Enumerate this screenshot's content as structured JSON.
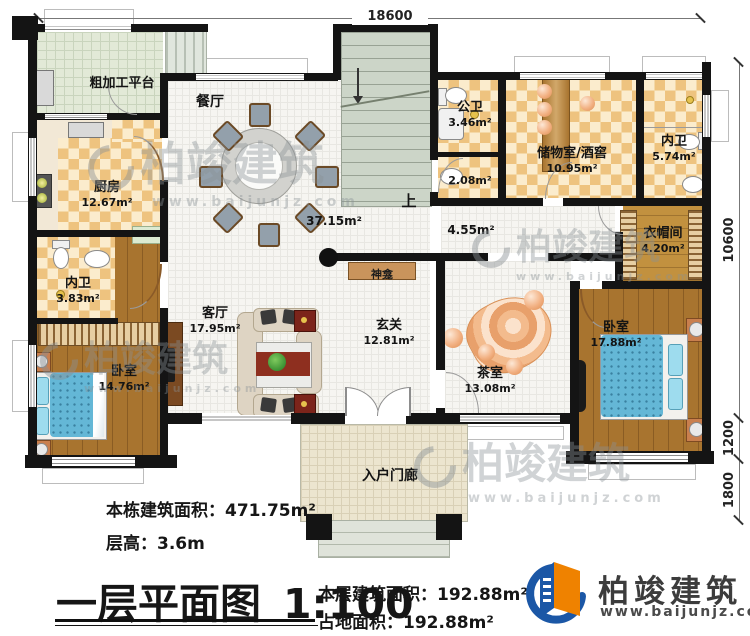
{
  "plan": {
    "title": "一层平面图",
    "scale": "1:100",
    "dimensions": {
      "top": "18600",
      "right_main": "10600",
      "right_mid": "1200",
      "right_low": "1800"
    },
    "rooms": [
      {
        "name": "粗加工平台",
        "area": ""
      },
      {
        "name": "厨房",
        "area": "12.67m²"
      },
      {
        "name": "内卫",
        "area": "3.83m²"
      },
      {
        "name": "卧室",
        "area": "14.76m²"
      },
      {
        "name": "餐厅",
        "area": "37.15m²"
      },
      {
        "name": "公卫",
        "area": "3.46m²"
      },
      {
        "name": "",
        "area": "2.08m²"
      },
      {
        "name": "储物室/酒窖",
        "area": "10.95m²"
      },
      {
        "name": "内卫",
        "area": "5.74m²"
      },
      {
        "name": "衣帽间",
        "area": "4.20m²"
      },
      {
        "name": "",
        "area": "4.55m²"
      },
      {
        "name": "神龛",
        "area": ""
      },
      {
        "name": "客厅",
        "area": "17.95m²"
      },
      {
        "name": "玄关",
        "area": "12.81m²"
      },
      {
        "name": "茶室",
        "area": "13.08m²"
      },
      {
        "name": "卧室",
        "area": "17.88m²"
      },
      {
        "name": "入户门廊",
        "area": ""
      },
      {
        "name": "上",
        "area": ""
      }
    ]
  },
  "summary": {
    "building_area_label": "本栋建筑面积：",
    "building_area_value": "471.75m²",
    "floor_height_label": "层高：",
    "floor_height_value": "3.6m",
    "floor_area_label": "本层建筑面积：",
    "floor_area_value": "192.88m²",
    "footprint_label": "占地面积：",
    "footprint_value": "192.88m²"
  },
  "brand": {
    "name": "柏竣建筑",
    "website": "www.baijunjz.com"
  },
  "watermark": {
    "text": "柏竣建筑",
    "subtext": "www.baijunjz.com"
  }
}
